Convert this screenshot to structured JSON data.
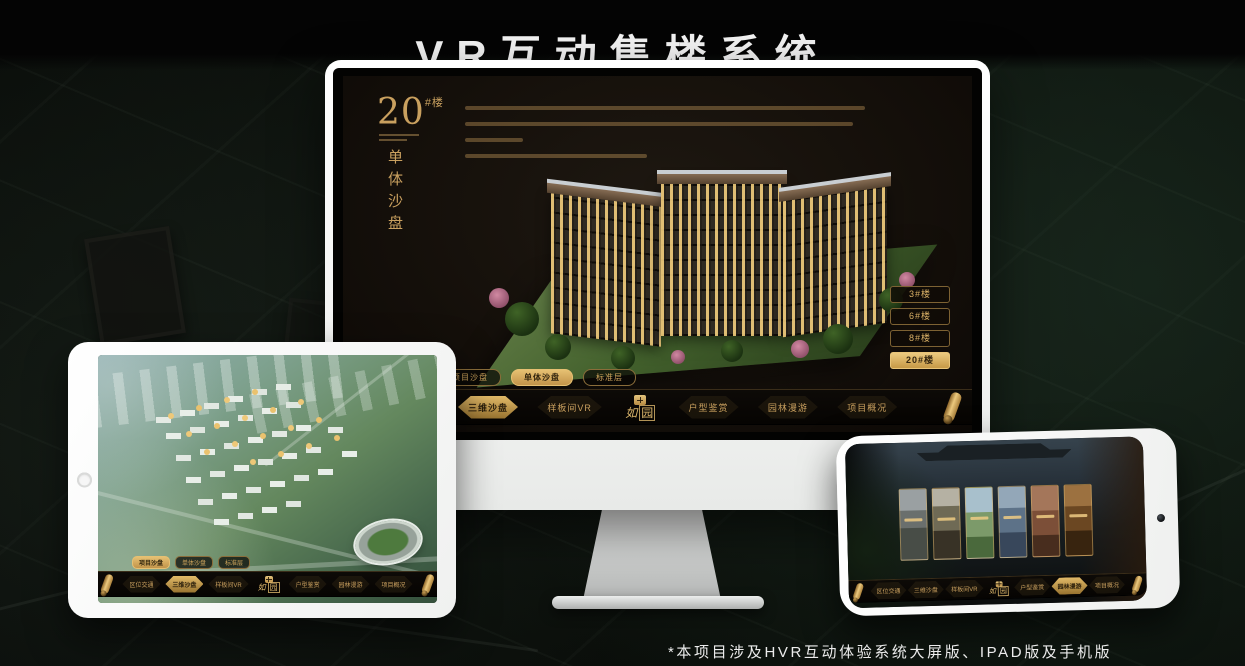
{
  "page": {
    "title": "VR互动售楼系统",
    "footnote": "*本项目涉及HVR互动体验系统大屏版、IPAD版及手机版"
  },
  "colors": {
    "gold": "#c9a05f",
    "gold_bright": "#ecca80",
    "active_tab_bg": "#e2ba68",
    "screen_bg": "#18130f",
    "nav_bg": "#0a0705",
    "page_bg": "#0d120e"
  },
  "monitor_ui": {
    "heading": {
      "number": "20",
      "unit": "#楼",
      "subtitle": "单体沙盘"
    },
    "floor_buttons": [
      {
        "label": "3#楼",
        "active": false
      },
      {
        "label": "6#楼",
        "active": false
      },
      {
        "label": "8#楼",
        "active": false
      },
      {
        "label": "20#楼",
        "active": true
      }
    ]
  },
  "subtabs": [
    {
      "label": "项目沙盘"
    },
    {
      "label": "单体沙盘"
    },
    {
      "label": "标准层"
    }
  ],
  "nav": {
    "logo": {
      "char1": "如",
      "char2": "园"
    },
    "items": [
      {
        "label": "区位交通"
      },
      {
        "label": "三维沙盘"
      },
      {
        "label": "样板间VR"
      },
      {
        "label": "户型鉴赏"
      },
      {
        "label": "园林漫游"
      },
      {
        "label": "项目概况"
      }
    ]
  }
}
